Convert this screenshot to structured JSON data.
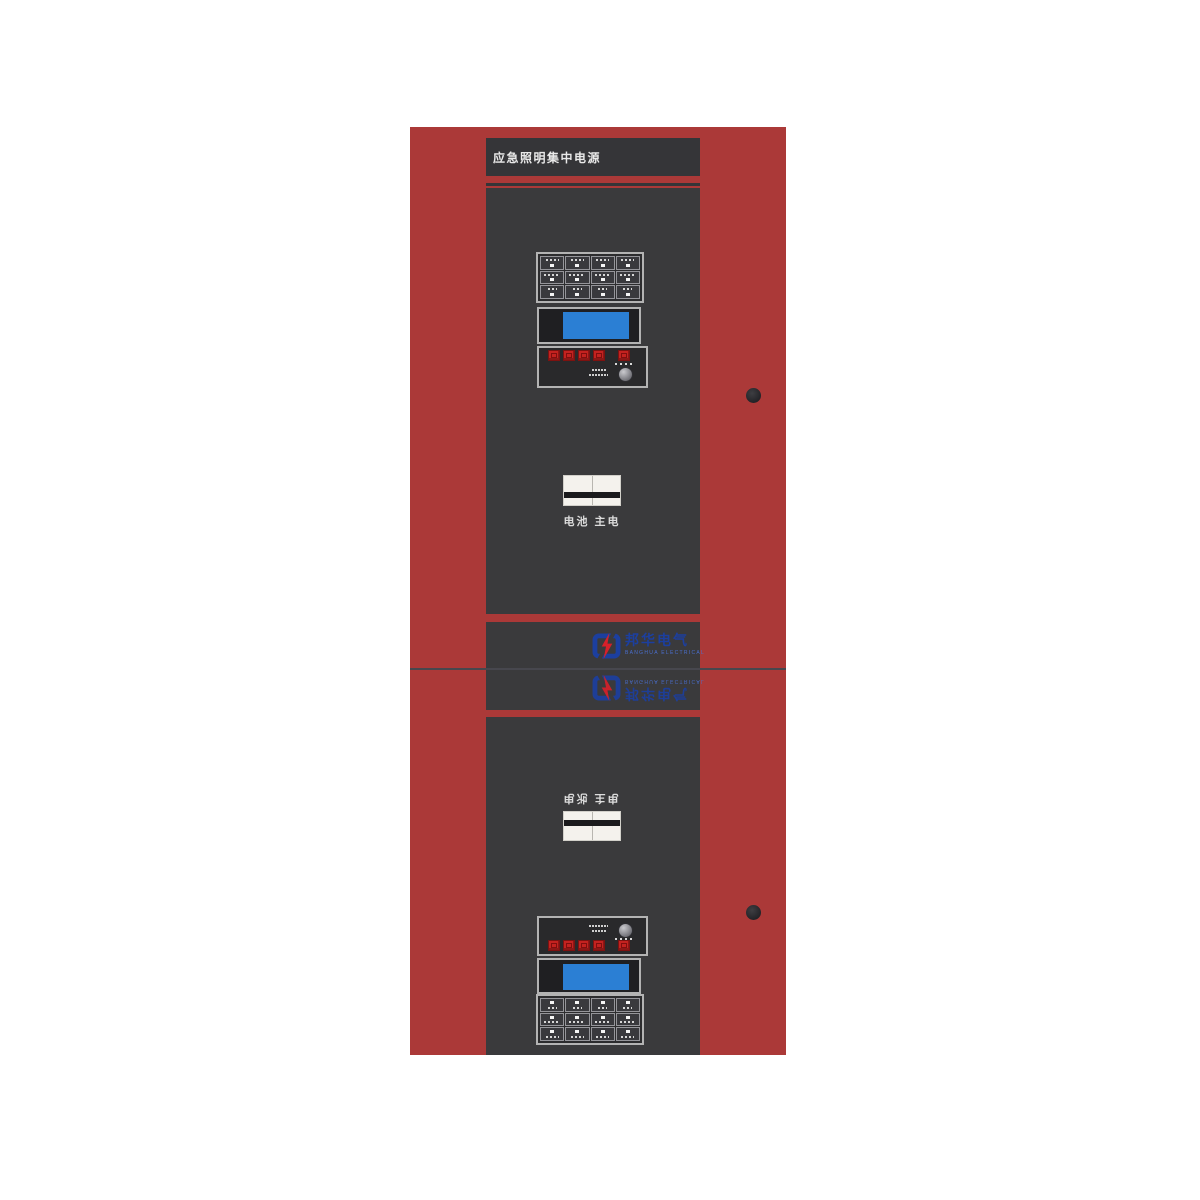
{
  "cabinet": {
    "title": "应急照明集中电源",
    "colors": {
      "body_red": "#ab3938",
      "panel_dark": "#3a3a3c",
      "lcd_blue": "#2b7fd4",
      "button_red": "#c32220",
      "logo_blue": "#1c3f9f",
      "logo_red": "#d6202a",
      "breaker_white": "#f4f2ed"
    },
    "top_unit": {
      "indicator_grid": {
        "rows": 3,
        "cols": 4
      },
      "red_button_count": 5,
      "breaker_label": "电池 主电"
    },
    "bottom_unit": {
      "indicator_grid": {
        "rows": 3,
        "cols": 4
      },
      "red_button_count": 5,
      "breaker_label": "电池 主电"
    },
    "logo": {
      "name": "邦华电气",
      "subtitle": "BANGHUA ELECTRICAL"
    }
  }
}
